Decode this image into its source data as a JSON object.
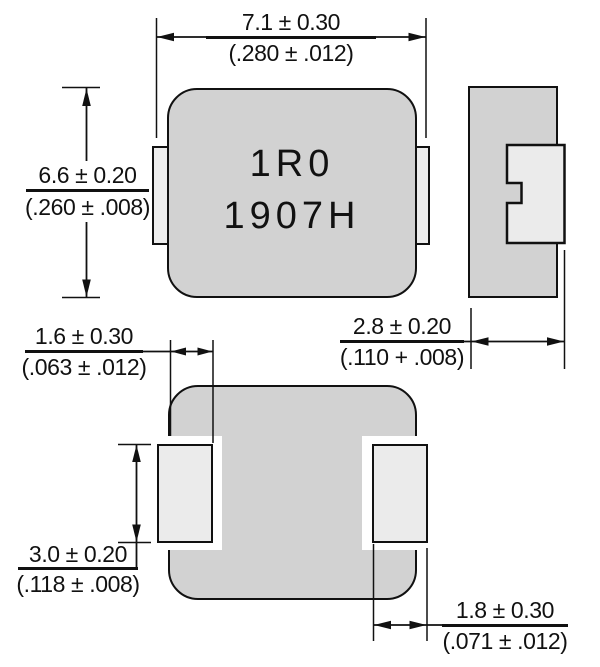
{
  "marking": {
    "line1": "1R0",
    "line2": "1907H"
  },
  "dims": {
    "width": {
      "mm": "7.1 ± 0.30",
      "inch": "(.280 ± .012)"
    },
    "height": {
      "mm": "6.6 ± 0.20",
      "inch": "(.260 ± .008)"
    },
    "thickness": {
      "mm": "2.8 ± 0.20",
      "inch": "(.110 + .008)"
    },
    "pad_top_length": {
      "mm": "1.6 ± 0.30",
      "inch": "(.063 ± .012)"
    },
    "pad_height": {
      "mm": "3.0 ± 0.20",
      "inch": "(.118 ± .008)"
    },
    "pad_width": {
      "mm": "1.8 ± 0.30",
      "inch": "(.071 ± .012)"
    }
  },
  "colors": {
    "body": "#d2d2d2",
    "terminal": "#ebebeb",
    "outline": "#111111",
    "background": "#ffffff"
  }
}
